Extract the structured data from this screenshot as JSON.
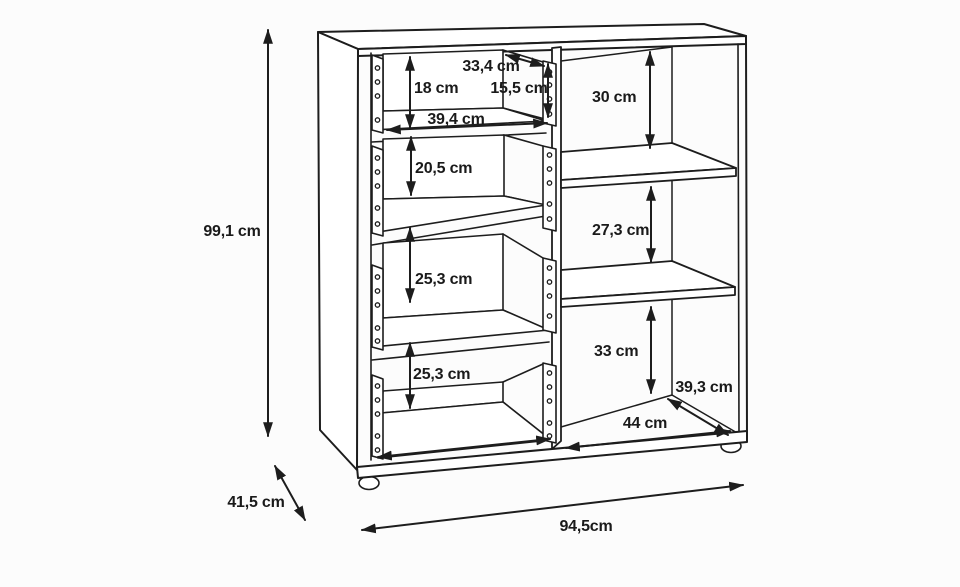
{
  "colors": {
    "line": "#1d1d1d",
    "text": "#1a1a1a",
    "background": "#fcfcfc",
    "surface": "#ffffff"
  },
  "labels": {
    "overall_height": "99,1 cm",
    "overall_depth": "41,5 cm",
    "overall_width": "94,5cm",
    "drawer1_height": "18 cm",
    "drawer1_depth": "33,4 cm",
    "drawer1_front_height": "15,5 cm",
    "drawer_inner_width": "39,4 cm",
    "drawer2_height": "20,5 cm",
    "drawer3_height": "25,3 cm",
    "drawer4_height": "25,3 cm",
    "shelf1_height": "30 cm",
    "shelf2_height": "27,3 cm",
    "shelf3_height": "33 cm",
    "shelf_depth": "39,3 cm",
    "shelf_inner_width": "44 cm"
  }
}
